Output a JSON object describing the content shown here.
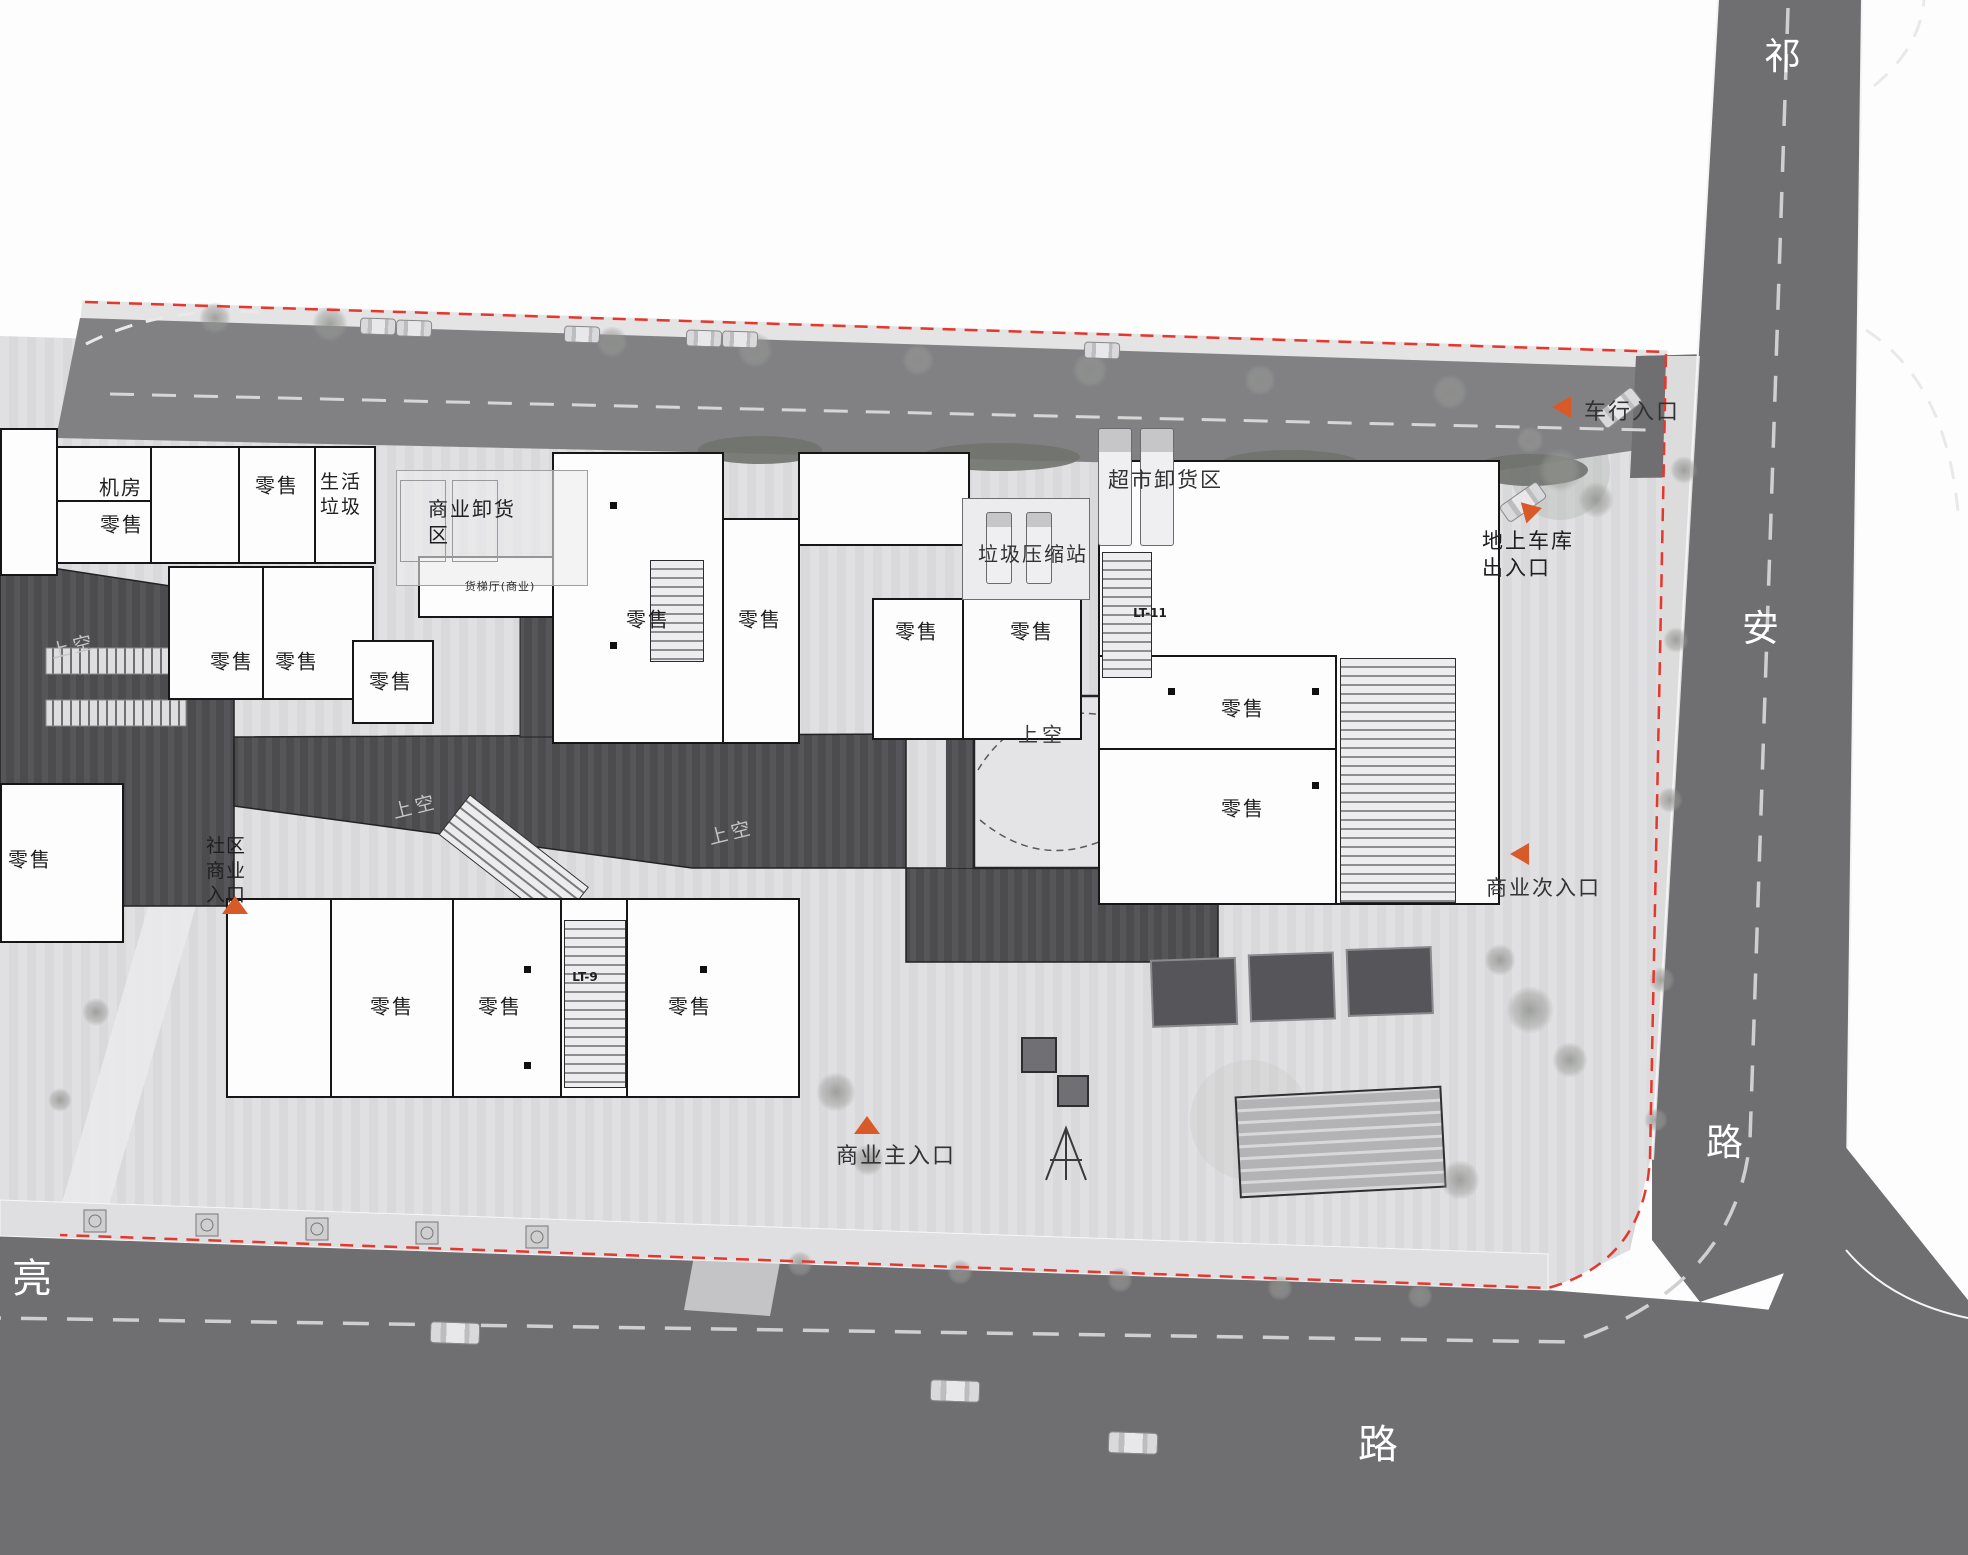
{
  "plan": {
    "roads": {
      "east_name": [
        "祁",
        "安",
        "路"
      ],
      "south_name_first": "亮",
      "south_name_last": "路"
    },
    "labels": {
      "retail": "零售",
      "machine_room": "机房",
      "domestic_waste": "生活垃圾",
      "commercial_unloading_area": "商业卸货区",
      "supermarket_unloading_area": "超市卸货区",
      "garbage_compression_station": "垃圾压缩站",
      "freight_elevator_lobby": "货梯厅(商业)",
      "void_above": "上空",
      "lt9": "LT-9",
      "lt11": "LT-11"
    },
    "entrances": {
      "vehicle": "车行入口",
      "garage": "地上车库出入口",
      "secondary": "商业次入口",
      "main": "商业主入口",
      "community": "社区商业入口"
    },
    "colors": {
      "accent_orange": "#d85a28",
      "boundary_red": "#e5372e",
      "road_gray": "#6f6f72",
      "spine_dark": "#4c4c4f"
    }
  }
}
